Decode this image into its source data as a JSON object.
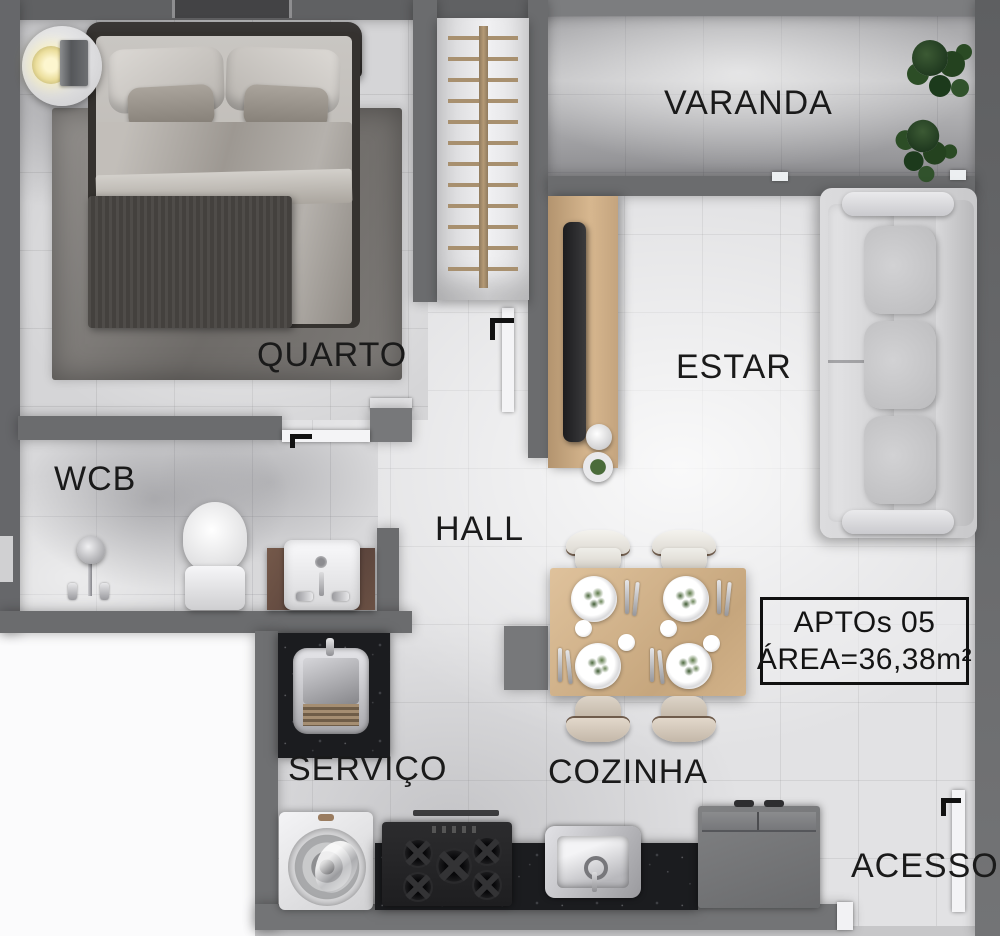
{
  "unit_label": {
    "line1": "APTOs 05",
    "line2": "ÁREA=36,38m²"
  },
  "rooms": {
    "varanda": "VARANDA",
    "quarto": "QUARTO",
    "estar": "ESTAR",
    "wcb": "WCB",
    "hall": "HALL",
    "servico": "SERVIÇO",
    "cozinha": "COZINHA",
    "acesso": "ACESSO"
  },
  "colors": {
    "wall": "#6b6c6e",
    "floor_light": "#e4e4e6",
    "floor_quarto": "#d5d5d7",
    "floor_varanda": "#c0c0c2",
    "granite_counter": "#1b1c1f",
    "wood_furniture": "#cfa985",
    "sofa": "#d6d6d8",
    "plant_green": "#2c4a26",
    "label_text": "#1a1a1a"
  }
}
